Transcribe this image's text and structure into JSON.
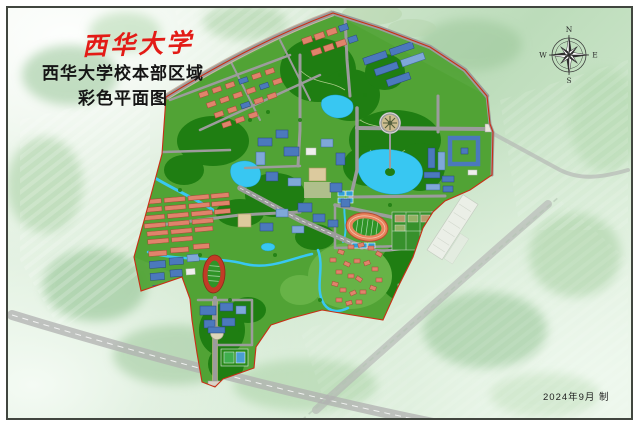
{
  "header": {
    "logo_text": "西华大学",
    "title_line1": "西华大学校本部区域",
    "title_line2": "彩色平面图"
  },
  "compass": {
    "n": "N",
    "e": "E",
    "s": "S",
    "w": "W"
  },
  "footer": {
    "date_text": "2024年9月 制"
  },
  "map": {
    "label": "西华大学校本部区域彩色平面图",
    "colors": {
      "logo_red": "#e31b16",
      "boundary_red": "#c92e16",
      "campus_green": "#51a336",
      "forest_green": "#1f7e12",
      "lake_blue": "#38c7f2",
      "road_gray": "#9c9c9c",
      "roof_salmon": "#e0836b",
      "roof_blue": "#4b79bd",
      "court_blue": "#2f9fd6",
      "track_orange": "#e8835c",
      "track_red": "#c23b26",
      "field_green": "#2f9427",
      "frame_gray": "#41463f"
    }
  }
}
